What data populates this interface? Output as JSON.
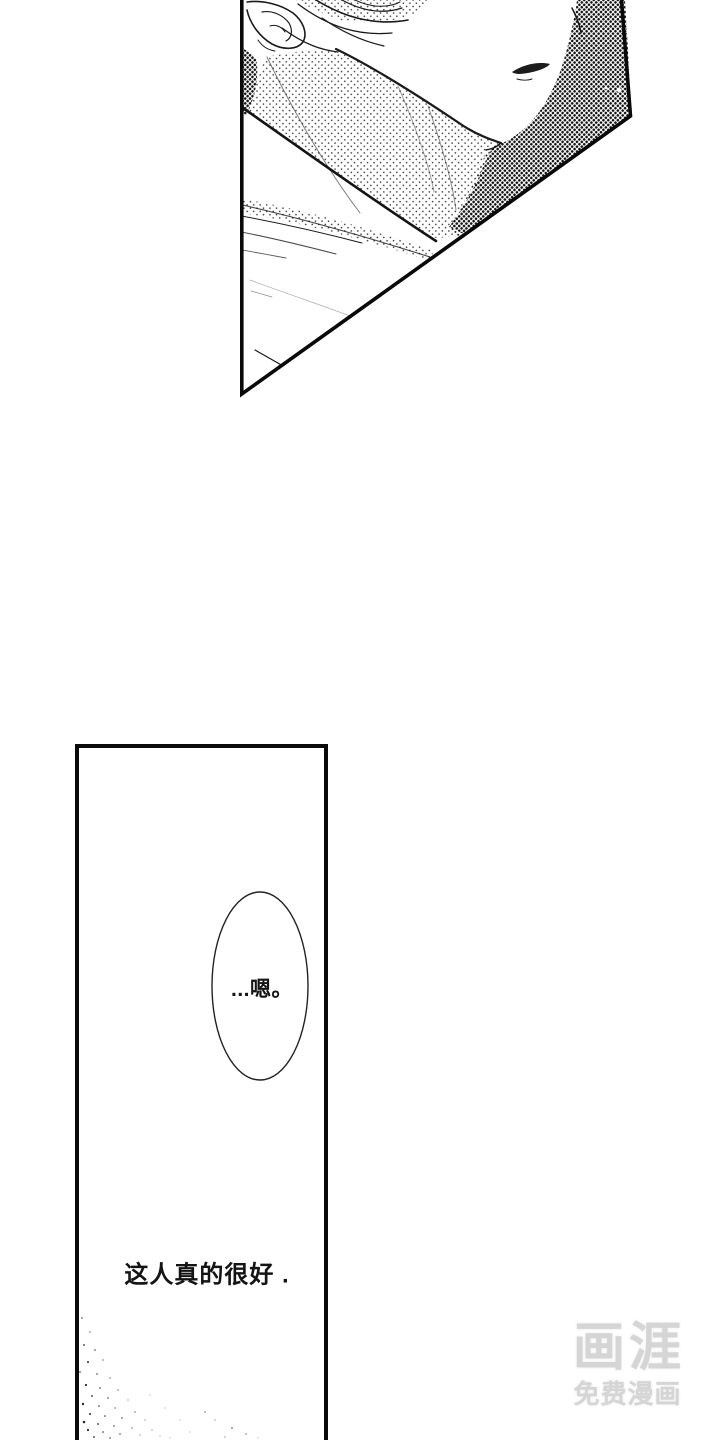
{
  "page": {
    "background": "#ffffff",
    "ink_color": "#141414"
  },
  "speech_bubble": {
    "text": "...嗯。"
  },
  "narration": {
    "text": "这人真的很好 ."
  },
  "watermark": {
    "logo": "画涯",
    "tagline": "免费漫画",
    "color": "#d5d5d5"
  }
}
